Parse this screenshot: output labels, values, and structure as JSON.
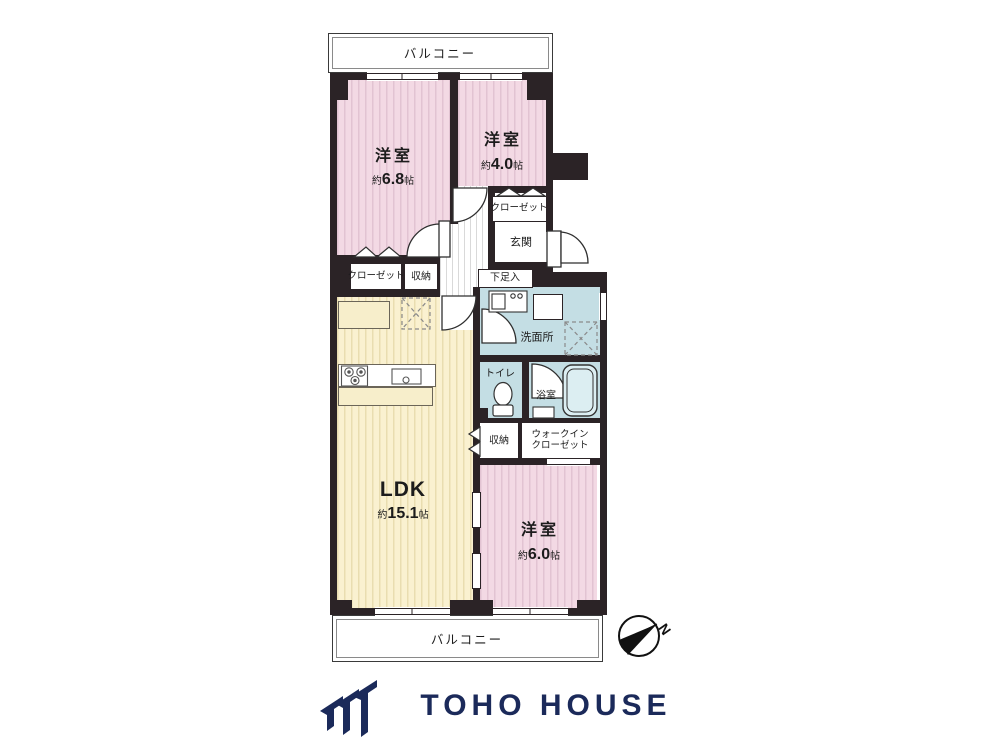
{
  "floorplan": {
    "balcony_top": "バルコニー",
    "balcony_bottom": "バルコニー",
    "rooms": {
      "bedroom1": {
        "name": "洋室",
        "approx": "約",
        "size": "6.8",
        "unit": "帖"
      },
      "bedroom2": {
        "name": "洋室",
        "approx": "約",
        "size": "4.0",
        "unit": "帖"
      },
      "bedroom3": {
        "name": "洋室",
        "approx": "約",
        "size": "6.0",
        "unit": "帖"
      },
      "ldk": {
        "name": "LDK",
        "approx": "約",
        "size": "15.1",
        "unit": "帖"
      },
      "entrance": "玄関",
      "shoe_box": "下足入",
      "closet_upper_right": "クローゼット",
      "closet_left": "クローゼット",
      "storage_upper": "収納",
      "storage_lower": "収納",
      "washroom": "洗面所",
      "toilet": "トイレ",
      "bathroom": "浴室",
      "walk_in_closet_line1": "ウォークイン",
      "walk_in_closet_line2": "クローゼット"
    },
    "compass": {
      "north_label": "N"
    },
    "colors": {
      "wall": "#2b2326",
      "room_pink": "#f3d9e4",
      "ldk_yellow": "#faf1d0",
      "wet_area_blue": "#c4dee4"
    }
  },
  "branding": {
    "logo_text": "TOHO HOUSE",
    "logo_color": "#1b2a5a"
  }
}
